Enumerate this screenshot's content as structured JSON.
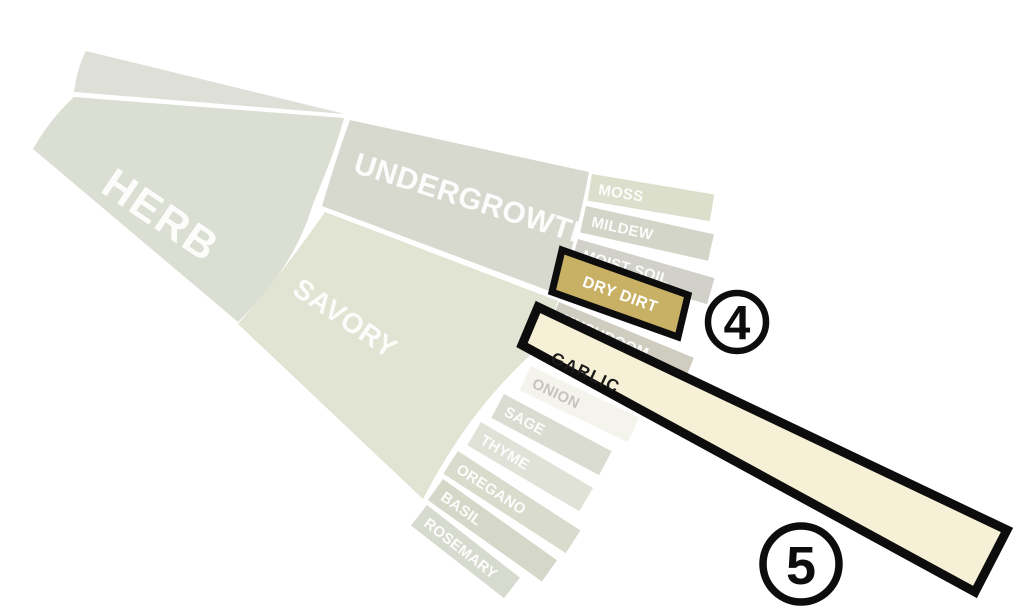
{
  "diagram": {
    "background": "#ffffff",
    "category": {
      "label": "HERB"
    },
    "subcategories": [
      {
        "label": "UNDERGROWTH"
      },
      {
        "label": "SAVORY"
      }
    ],
    "leaves": [
      {
        "label": "MOSS",
        "fill": "#dbdfcc",
        "text_color": "#ffffff"
      },
      {
        "label": "MILDEW",
        "fill": "#d2d5c8",
        "text_color": "#ffffff"
      },
      {
        "label": "MOIST SOIL",
        "fill": "#d1d0c9",
        "text_color": "#ffffff"
      },
      {
        "label": "MUSHROOM",
        "fill": "#cfccc0",
        "text_color": "#ffffff"
      },
      {
        "label": "ONION",
        "fill": "#f4f4ed",
        "text_color": "#c5c5bd"
      },
      {
        "label": "SAGE",
        "fill": "#dadcd2",
        "text_color": "#ffffff"
      },
      {
        "label": "THYME",
        "fill": "#e0e2d8",
        "text_color": "#ffffff"
      },
      {
        "label": "OREGANO",
        "fill": "#d9dbcd",
        "text_color": "#ffffff"
      },
      {
        "label": "BASIL",
        "fill": "#d5d8c9",
        "text_color": "#ffffff"
      },
      {
        "label": "ROSEMARY",
        "fill": "#d7dace",
        "text_color": "#ffffff"
      }
    ],
    "highlights": [
      {
        "label": "DRY DIRT",
        "fill": "#c8b164",
        "text_color": "#ffffff",
        "border_color": "#0d0d0d",
        "callout_number": "4"
      },
      {
        "label": "GARLIC",
        "fill": "#f6f1d6",
        "text_color": "#1a1a1a",
        "border_color": "#0d0d0d",
        "callout_number": "5"
      }
    ],
    "region_fills": {
      "sliver": "#dee0d8",
      "herb": "#dbded3",
      "undergrowth": "#d7d9cf",
      "savory": "#e1e3d3"
    },
    "label_color": "#ffffff",
    "callout_style": {
      "ring_color": "#0d0d0d",
      "fill": "#ffffff",
      "number_color": "#0d0d0d"
    }
  }
}
